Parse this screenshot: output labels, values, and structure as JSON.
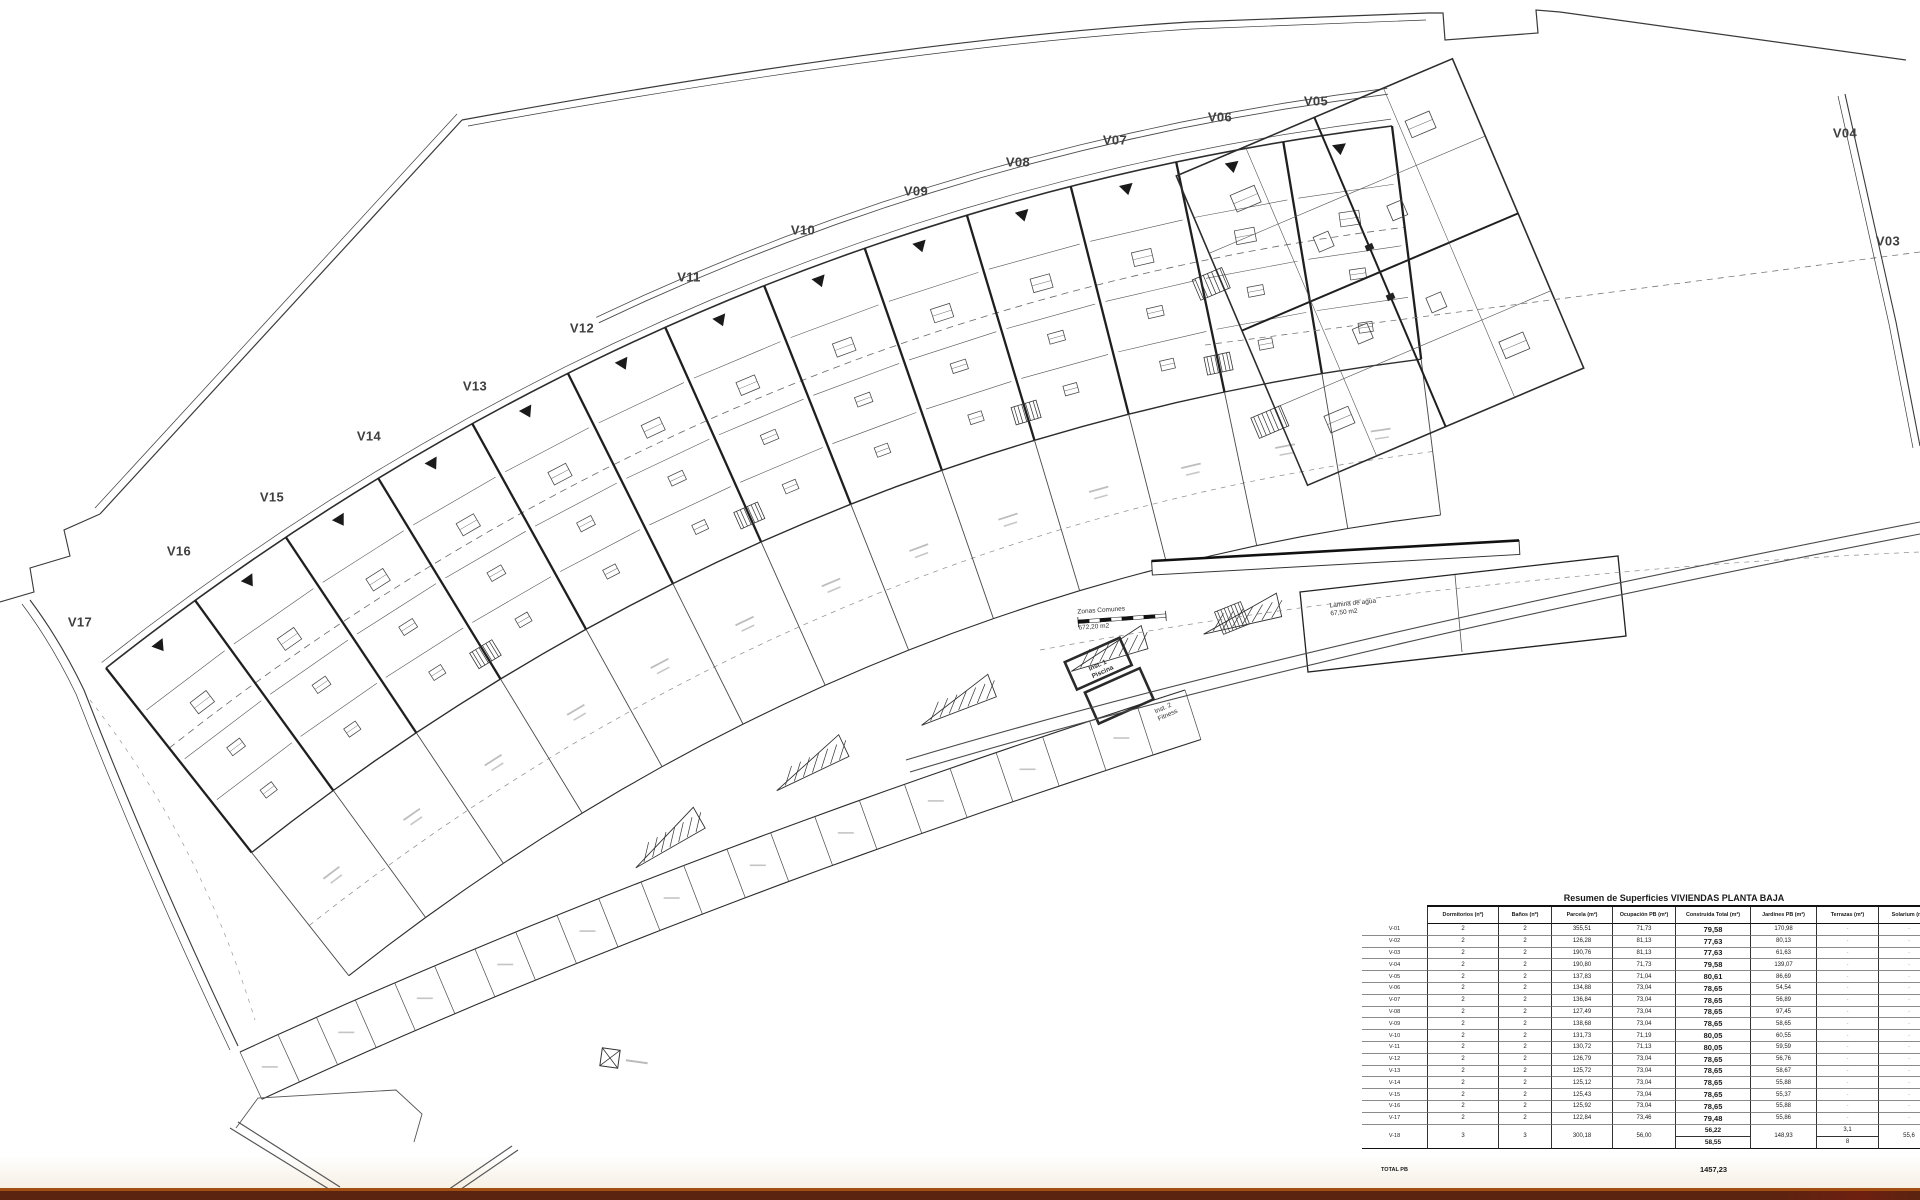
{
  "plan": {
    "villa_labels": [
      {
        "id": "V05",
        "x": 1316,
        "y": 101
      },
      {
        "id": "V06",
        "x": 1220,
        "y": 117
      },
      {
        "id": "V07",
        "x": 1115,
        "y": 140
      },
      {
        "id": "V08",
        "x": 1018,
        "y": 162
      },
      {
        "id": "V09",
        "x": 916,
        "y": 191
      },
      {
        "id": "V10",
        "x": 803,
        "y": 230
      },
      {
        "id": "V11",
        "x": 689,
        "y": 277
      },
      {
        "id": "V12",
        "x": 582,
        "y": 328
      },
      {
        "id": "V13",
        "x": 475,
        "y": 386
      },
      {
        "id": "V14",
        "x": 369,
        "y": 436
      },
      {
        "id": "V15",
        "x": 272,
        "y": 497
      },
      {
        "id": "V16",
        "x": 179,
        "y": 551
      },
      {
        "id": "V17",
        "x": 80,
        "y": 622
      },
      {
        "id": "V04",
        "x": 1845,
        "y": 133
      },
      {
        "id": "V03",
        "x": 1888,
        "y": 241
      }
    ],
    "annotations": [
      {
        "name": "zonas-comunes",
        "lines": [
          "Zonas Comunes",
          "672,20 m2"
        ],
        "x": 1078,
        "y": 607,
        "rot": -4,
        "bold": false,
        "gap": true
      },
      {
        "name": "lamina-de-agua",
        "lines": [
          "Lámina de agua",
          "67,50 m2"
        ],
        "x": 1330,
        "y": 600,
        "rot": -6,
        "bold": false,
        "gap": false
      },
      {
        "name": "inst-1-piscina",
        "lines": [
          "Inst. 1",
          "Piscina"
        ],
        "x": 1090,
        "y": 661,
        "rot": -24,
        "bold": true,
        "gap": false
      },
      {
        "name": "inst-2-fitness",
        "lines": [
          "Inst. 2",
          "Fitness"
        ],
        "x": 1156,
        "y": 704,
        "rot": -24,
        "bold": false,
        "gap": false
      }
    ]
  },
  "table": {
    "title": "Resumen de Superficies VIVIENDAS PLANTA BAJA",
    "columns": [
      "",
      "Dormitorios (nº)",
      "Baños (nº)",
      "Parcela (m²)",
      "Ocupación PB (m²)",
      "Construida Total (m²)",
      "Jardines PB (m²)",
      "Terrazas (m²)",
      "Solarium (m²)"
    ],
    "rows": [
      {
        "id": "V-01",
        "dormitorios": "2",
        "banos": "2",
        "parcela": "355,51",
        "ocupacion": "71,73",
        "construida": "79,58",
        "jardines": "170,98",
        "terrazas": "-",
        "solarium": "-"
      },
      {
        "id": "V-02",
        "dormitorios": "2",
        "banos": "2",
        "parcela": "126,28",
        "ocupacion": "81,13",
        "construida": "77,63",
        "jardines": "80,13",
        "terrazas": "-",
        "solarium": "-"
      },
      {
        "id": "V-03",
        "dormitorios": "2",
        "banos": "2",
        "parcela": "190,76",
        "ocupacion": "81,13",
        "construida": "77,63",
        "jardines": "61,63",
        "terrazas": "-",
        "solarium": "-"
      },
      {
        "id": "V-04",
        "dormitorios": "2",
        "banos": "2",
        "parcela": "190,80",
        "ocupacion": "71,73",
        "construida": "79,58",
        "jardines": "139,07",
        "terrazas": "-",
        "solarium": "-"
      },
      {
        "id": "V-05",
        "dormitorios": "2",
        "banos": "2",
        "parcela": "137,83",
        "ocupacion": "71,04",
        "construida": "80,61",
        "jardines": "86,69",
        "terrazas": "-",
        "solarium": "-"
      },
      {
        "id": "V-06",
        "dormitorios": "2",
        "banos": "2",
        "parcela": "134,88",
        "ocupacion": "73,04",
        "construida": "78,65",
        "jardines": "54,54",
        "terrazas": "-",
        "solarium": "-"
      },
      {
        "id": "V-07",
        "dormitorios": "2",
        "banos": "2",
        "parcela": "136,84",
        "ocupacion": "73,04",
        "construida": "78,65",
        "jardines": "56,89",
        "terrazas": "-",
        "solarium": "-"
      },
      {
        "id": "V-08",
        "dormitorios": "2",
        "banos": "2",
        "parcela": "127,49",
        "ocupacion": "73,04",
        "construida": "78,65",
        "jardines": "97,45",
        "terrazas": "-",
        "solarium": "-"
      },
      {
        "id": "V-09",
        "dormitorios": "2",
        "banos": "2",
        "parcela": "138,68",
        "ocupacion": "73,04",
        "construida": "78,65",
        "jardines": "58,65",
        "terrazas": "-",
        "solarium": "-"
      },
      {
        "id": "V-10",
        "dormitorios": "2",
        "banos": "2",
        "parcela": "131,73",
        "ocupacion": "71,19",
        "construida": "80,05",
        "jardines": "60,55",
        "terrazas": "-",
        "solarium": "-"
      },
      {
        "id": "V-11",
        "dormitorios": "2",
        "banos": "2",
        "parcela": "130,72",
        "ocupacion": "71,13",
        "construida": "80,05",
        "jardines": "59,59",
        "terrazas": "-",
        "solarium": "-"
      },
      {
        "id": "V-12",
        "dormitorios": "2",
        "banos": "2",
        "parcela": "126,79",
        "ocupacion": "73,04",
        "construida": "78,65",
        "jardines": "56,76",
        "terrazas": "-",
        "solarium": "-"
      },
      {
        "id": "V-13",
        "dormitorios": "2",
        "banos": "2",
        "parcela": "125,72",
        "ocupacion": "73,04",
        "construida": "78,65",
        "jardines": "58,67",
        "terrazas": "-",
        "solarium": "-"
      },
      {
        "id": "V-14",
        "dormitorios": "2",
        "banos": "2",
        "parcela": "125,12",
        "ocupacion": "73,04",
        "construida": "78,65",
        "jardines": "55,88",
        "terrazas": "-",
        "solarium": "-"
      },
      {
        "id": "V-15",
        "dormitorios": "2",
        "banos": "2",
        "parcela": "125,43",
        "ocupacion": "73,04",
        "construida": "78,65",
        "jardines": "55,37",
        "terrazas": "-",
        "solarium": "-"
      },
      {
        "id": "V-16",
        "dormitorios": "2",
        "banos": "2",
        "parcela": "125,92",
        "ocupacion": "73,04",
        "construida": "78,65",
        "jardines": "55,88",
        "terrazas": "-",
        "solarium": "-"
      },
      {
        "id": "V-17",
        "dormitorios": "2",
        "banos": "2",
        "parcela": "122,84",
        "ocupacion": "73,46",
        "construida": "79,48",
        "jardines": "55,86",
        "terrazas": "-",
        "solarium": "-"
      },
      {
        "id": "V-18",
        "dormitorios": "3",
        "banos": "3",
        "parcela": "300,18",
        "ocupacion": "56,00",
        "construida": "56,22",
        "construida2": "58,55",
        "jardines": "148,93",
        "terrazas": "3,1",
        "terrazas2": "8",
        "solarium": "55,6"
      }
    ],
    "total_label": "TOTAL PB",
    "total_value": "1457,23"
  },
  "footer": {
    "bar_dark": "#5a2410",
    "bar_edge": "#a24e12",
    "paper_cream": "#f6efe3"
  }
}
